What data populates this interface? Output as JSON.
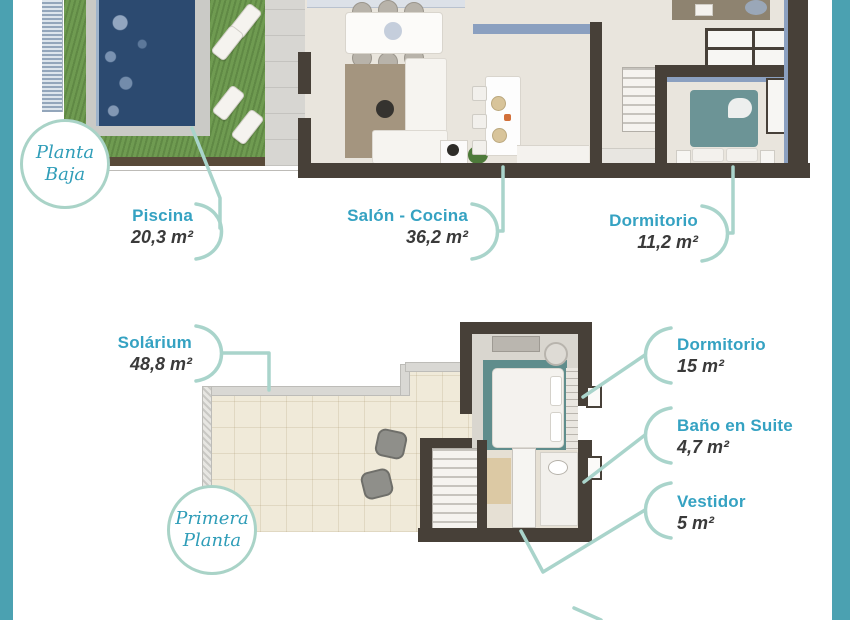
{
  "colors": {
    "accent_teal_bar": "#4ba1b1",
    "label_teal": "#35a2c2",
    "label_value": "#3a3a3a",
    "leader_line": "#a9d4cb",
    "badge_border": "#a9d3c7",
    "badge_text": "#2f9db8",
    "wall_dark": "#474038",
    "wall_blue": "#8ba0c0",
    "pool_water": "#2c4a70",
    "grass": "#6f9b51",
    "floor_beige": "#e9e5dd",
    "tile_cream": "#f0ead9",
    "bed_teal": "#6c9496"
  },
  "badges": {
    "ground": {
      "line1": "Planta",
      "line2": "Baja"
    },
    "first": {
      "line1": "Primera",
      "line2": "Planta"
    }
  },
  "labels": {
    "piscina": {
      "name": "Piscina",
      "area": "20,3 m²"
    },
    "salon": {
      "name": "Salón - Cocina",
      "area": "36,2 m²"
    },
    "dormitorio_pb": {
      "name": "Dormitorio",
      "area": "11,2 m²"
    },
    "solarium": {
      "name": "Solárium",
      "area": "48,8 m²"
    },
    "dormitorio_p1": {
      "name": "Dormitorio",
      "area": "15 m²"
    },
    "bano": {
      "name": "Baño en Suite",
      "area": "4,7 m²"
    },
    "vestidor": {
      "name": "Vestidor",
      "area": "5 m²"
    }
  }
}
